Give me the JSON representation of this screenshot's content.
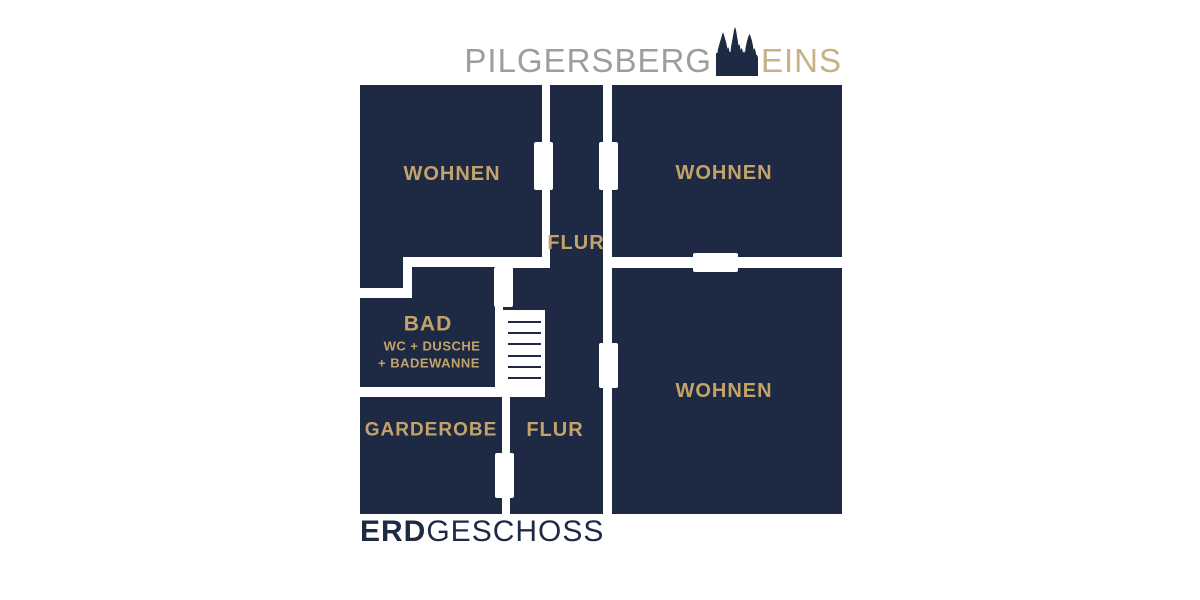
{
  "header": {
    "brand_main": "PILGERSBERG",
    "brand_accent": "EINS",
    "icon": "cathedral-icon"
  },
  "plan": {
    "rooms": {
      "wohnen_top_left": {
        "label": "WOHNEN"
      },
      "wohnen_top_right": {
        "label": "WOHNEN"
      },
      "wohnen_bottom_right": {
        "label": "WOHNEN"
      },
      "flur_top": {
        "label": "FLUR"
      },
      "flur_bottom": {
        "label": "FLUR"
      },
      "bad": {
        "label": "BAD",
        "sublabel_line1": "WC + DUSCHE",
        "sublabel_line2": "+ BADEWANNE"
      },
      "garderobe": {
        "label": "GARDEROBE"
      }
    }
  },
  "footer": {
    "title_bold": "ERD",
    "title_light": "GESCHOSS"
  },
  "colors": {
    "navy": "#1e2944",
    "gold": "#c3a369",
    "logo_gray": "#9d9d9d",
    "logo_gold": "#c8b184",
    "background": "#ffffff"
  }
}
